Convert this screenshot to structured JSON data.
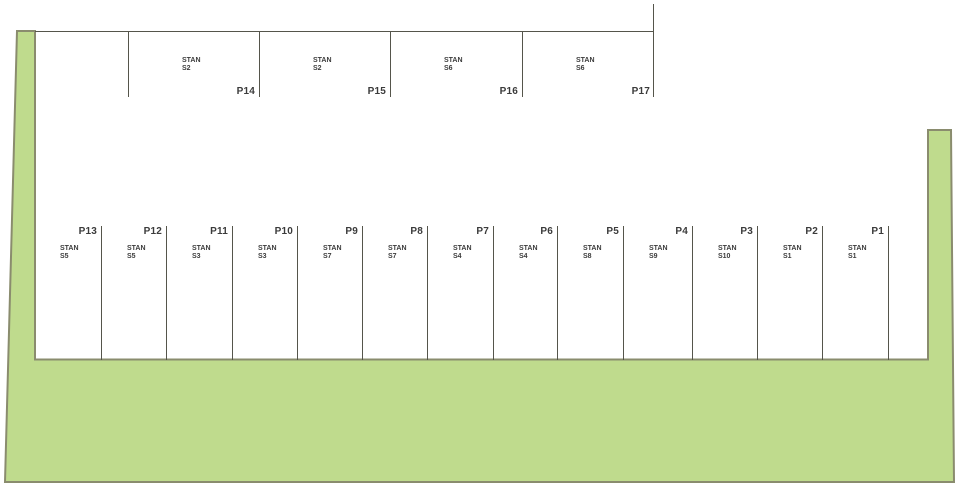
{
  "plan": {
    "colors": {
      "green_fill": "#bfdb8d",
      "green_border": "#8a8c6e",
      "line": "#55554b",
      "text": "#3b3b3b"
    },
    "top_row": [
      {
        "id": "P14",
        "unit": "STAN",
        "code": "S2",
        "left": 128,
        "width": 131
      },
      {
        "id": "P15",
        "unit": "STAN",
        "code": "S2",
        "left": 259,
        "width": 131
      },
      {
        "id": "P16",
        "unit": "STAN",
        "code": "S6",
        "left": 390,
        "width": 132
      },
      {
        "id": "P17",
        "unit": "STAN",
        "code": "S6",
        "left": 522,
        "width": 132
      }
    ],
    "bottom_row": [
      {
        "id": "P13",
        "unit": "STAN",
        "code": "S5",
        "left": 35,
        "width": 67
      },
      {
        "id": "P12",
        "unit": "STAN",
        "code": "S5",
        "left": 102,
        "width": 65
      },
      {
        "id": "P11",
        "unit": "STAN",
        "code": "S3",
        "left": 167,
        "width": 66
      },
      {
        "id": "P10",
        "unit": "STAN",
        "code": "S3",
        "left": 233,
        "width": 65
      },
      {
        "id": "P9",
        "unit": "STAN",
        "code": "S7",
        "left": 298,
        "width": 65
      },
      {
        "id": "P8",
        "unit": "STAN",
        "code": "S7",
        "left": 363,
        "width": 65
      },
      {
        "id": "P7",
        "unit": "STAN",
        "code": "S4",
        "left": 428,
        "width": 66
      },
      {
        "id": "P6",
        "unit": "STAN",
        "code": "S4",
        "left": 494,
        "width": 64
      },
      {
        "id": "P5",
        "unit": "STAN",
        "code": "S8",
        "left": 558,
        "width": 66
      },
      {
        "id": "P4",
        "unit": "STAN",
        "code": "S9",
        "left": 624,
        "width": 69
      },
      {
        "id": "P3",
        "unit": "STAN",
        "code": "S10",
        "left": 693,
        "width": 65
      },
      {
        "id": "P2",
        "unit": "STAN",
        "code": "S1",
        "left": 758,
        "width": 65
      },
      {
        "id": "P1",
        "unit": "STAN",
        "code": "S1",
        "left": 823,
        "width": 66
      }
    ]
  }
}
